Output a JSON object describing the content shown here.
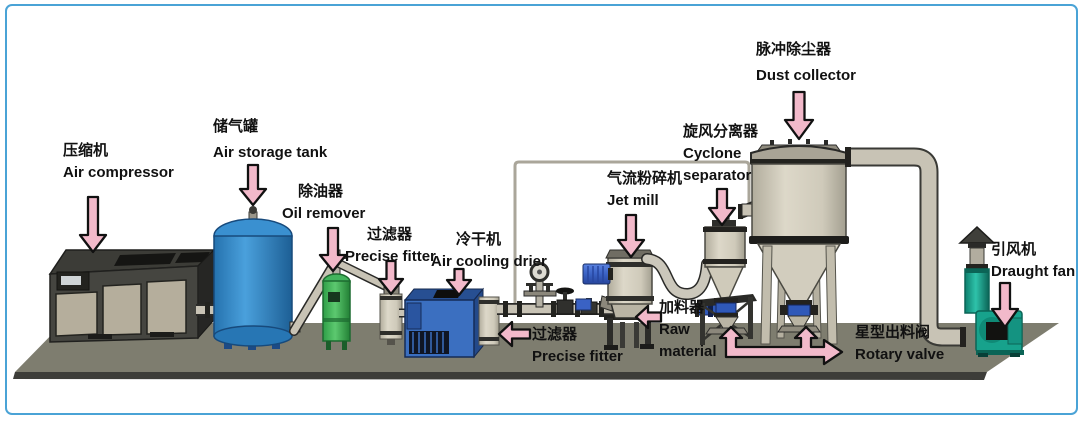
{
  "colors": {
    "frame-blue": "#4aa3d6",
    "arrow-pink": "#f2b9ca",
    "platform-gray": "#7e7d6f",
    "platform-edge": "#3d3d39",
    "tank-blue": "#3f97d6",
    "oil-remover-green": "#42b45c",
    "drier-blue": "#3b6fc0",
    "fan-teal": "#17a28c",
    "vessel-beige": "#d2cdbd",
    "pipe-gray": "#c8c3b5",
    "motor-blue": "#3a62c4",
    "valve-blue": "#2f58b8",
    "compressor-dark": "#454540",
    "panel-beige": "#b5ae9c",
    "text": "#111111"
  },
  "labels": {
    "air_compressor": {
      "zh": "压缩机",
      "en": "Air compressor"
    },
    "air_storage_tank": {
      "zh": "储气罐",
      "en": "Air storage tank"
    },
    "oil_remover": {
      "zh": "除油器",
      "en": "Oil remover"
    },
    "precise_fitter_1": {
      "zh": "过滤器",
      "en": "Precise fitter"
    },
    "air_cooling_drier": {
      "zh": "冷干机",
      "en": "Air cooling drier"
    },
    "precise_fitter_2": {
      "zh": "过滤器",
      "en": "Precise fitter"
    },
    "jet_mill": {
      "zh": "气流粉碎机",
      "en": "Jet mill"
    },
    "raw_material_feeder": {
      "zh": "加料器",
      "en_line1": "Raw",
      "en_line2": "material"
    },
    "cyclone_separator": {
      "zh": "旋风分离器",
      "en_line1": "Cyclone",
      "en_line2": "separator"
    },
    "dust_collector": {
      "zh": "脉冲除尘器",
      "en": "Dust collector"
    },
    "draught_fan": {
      "zh": "引风机",
      "en": "Draught fan"
    },
    "rotary_valve": {
      "zh": "星型出料阀",
      "en": "Rotary valve"
    }
  }
}
